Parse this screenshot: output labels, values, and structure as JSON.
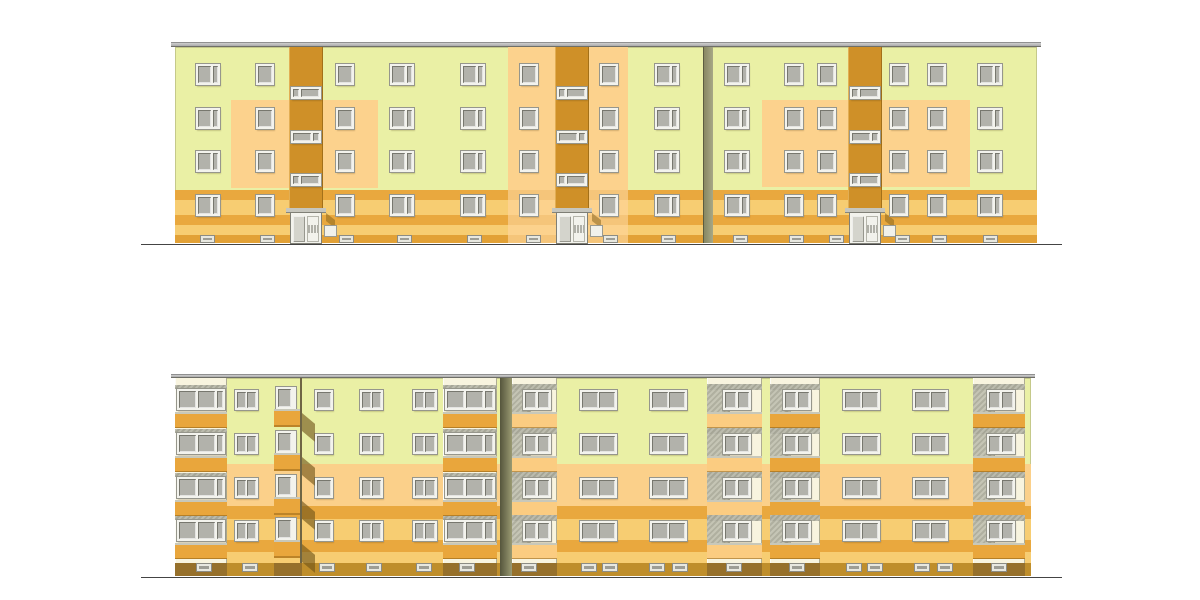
{
  "scene": {
    "width": 1200,
    "height": 600,
    "background": "#ffffff"
  },
  "colors": {
    "green": "#eaf0a5",
    "peach": "#fcd28d",
    "peachBand": "#fbd08a",
    "midStripe": "#f3c276",
    "stairwell": "#cf9028",
    "stripeDark": "#e9a83e",
    "stripeLight": "#f7cd72",
    "plinthTop": "#e2a136",
    "plinthBottom": "#bf8e2b",
    "plinthUnderStack": "#96702b",
    "parapetOrange": "#e9a63c",
    "parapetPeach": "#fbcc81",
    "cream": "#f8f4df",
    "slabGray": "#b4b4a5",
    "frame": "#f3f3ed",
    "glass": "#b2b2ab",
    "roof": "#bdbdbd",
    "ground": "#444444",
    "jointOliveLight": "#a8a886",
    "jointOliveDark": "#84845f",
    "jointShadowDark": "#55553c",
    "jointShadowLight": "#9a9a72",
    "edgeLine": "#6f6544",
    "canopy": "#c6c6be",
    "doorLeaf": "#d4d4cc",
    "shadow": "rgba(112,84,24,0.62)"
  },
  "ground_lines": [
    {
      "x": 141,
      "y": 244,
      "w": 921,
      "h": 1
    },
    {
      "x": 141,
      "y": 577,
      "w": 921,
      "h": 1
    }
  ],
  "top_building": {
    "wall": {
      "x": 175,
      "y": 47,
      "w": 862,
      "h": 196
    },
    "roof": {
      "x": 171,
      "y": 42,
      "w": 870,
      "h": 5
    },
    "stripes": [
      {
        "y": 190,
        "h": 10,
        "color": "stripeDark"
      },
      {
        "y": 200,
        "h": 15,
        "color": "stripeLight"
      },
      {
        "y": 215,
        "h": 10,
        "color": "stripeDark"
      },
      {
        "y": 225,
        "h": 10,
        "color": "stripeLight"
      },
      {
        "y": 235,
        "h": 8,
        "color": "plinthTop"
      }
    ],
    "patches": [
      {
        "x": 231,
        "y": 100,
        "w": 147,
        "h": 88
      },
      {
        "x": 762,
        "y": 100,
        "w": 208,
        "h": 87
      }
    ],
    "mid_column": {
      "x": 508,
      "w": 120,
      "stripes": [
        {
          "y": 190,
          "h": 10
        },
        {
          "y": 215,
          "h": 10
        },
        {
          "y": 235,
          "h": 8
        }
      ]
    },
    "joint": {
      "x": 703,
      "w": 10
    },
    "window_rows": [
      64,
      108,
      151,
      195
    ],
    "window_h": 21,
    "window_cols": [
      {
        "x": 196,
        "t": "d"
      },
      {
        "x": 256,
        "t": "s"
      },
      {
        "x": 336,
        "t": "s"
      },
      {
        "x": 390,
        "t": "d"
      },
      {
        "x": 461,
        "t": "d"
      },
      {
        "x": 520,
        "t": "s"
      },
      {
        "x": 600,
        "t": "s"
      },
      {
        "x": 655,
        "t": "d"
      },
      {
        "x": 725,
        "t": "d"
      },
      {
        "x": 785,
        "t": "s"
      },
      {
        "x": 818,
        "t": "s"
      },
      {
        "x": 890,
        "t": "s"
      },
      {
        "x": 928,
        "t": "s"
      },
      {
        "x": 978,
        "t": "d"
      }
    ],
    "stairwells": [
      {
        "x": 289
      },
      {
        "x": 555
      },
      {
        "x": 848
      }
    ],
    "stairwell_w": 34,
    "landing_ys": [
      87,
      131,
      174
    ],
    "canopy_y": 208,
    "door": {
      "y": 213,
      "h": 30
    },
    "vents": {
      "y": 236,
      "h": 6,
      "w": 13,
      "xs": [
        201,
        261,
        340,
        398,
        468,
        527,
        604,
        662,
        734,
        790,
        830,
        896,
        933,
        984
      ]
    }
  },
  "bottom_building": {
    "wall": {
      "x": 175,
      "y": 378,
      "w": 856,
      "h": 198
    },
    "roof": {
      "x": 171,
      "y": 374,
      "w": 864,
      "h": 4
    },
    "bands": [
      {
        "y": 464,
        "h": 42,
        "color": "peachBand"
      },
      {
        "y": 506,
        "h": 13,
        "color": "stripeDark"
      },
      {
        "y": 519,
        "h": 21,
        "color": "stripeLight"
      },
      {
        "y": 540,
        "h": 12,
        "color": "stripeDark"
      },
      {
        "y": 552,
        "h": 11,
        "color": "stripeLight"
      },
      {
        "y": 563,
        "h": 13,
        "color": "plinthBottom"
      }
    ],
    "joint": {
      "x": 500,
      "w": 12
    },
    "window_rows": [
      390,
      434,
      478,
      521
    ],
    "window_h": 20,
    "window_cols": [
      {
        "x": 235,
        "w": 23,
        "panes": 2
      },
      {
        "x": 315,
        "w": 18,
        "panes": 1
      },
      {
        "x": 360,
        "w": 23,
        "panes": 2
      },
      {
        "x": 413,
        "w": 24,
        "panes": 2
      },
      {
        "x": 580,
        "w": 37,
        "panes": 2
      },
      {
        "x": 650,
        "w": 37,
        "panes": 2
      },
      {
        "x": 843,
        "w": 37,
        "panes": 2
      },
      {
        "x": 913,
        "w": 35,
        "panes": 2
      }
    ],
    "stacks": [
      {
        "x": 175,
        "w": 52,
        "kind": "glazed",
        "parapet": "parapetOrange"
      },
      {
        "x": 274,
        "w": 28,
        "kind": "profile",
        "parapet": "parapetOrange"
      },
      {
        "x": 443,
        "w": 54,
        "kind": "glazed",
        "parapet": "parapetOrange"
      },
      {
        "x": 512,
        "w": 45,
        "kind": "window",
        "parapet": "parapetPeach"
      },
      {
        "x": 707,
        "w": 55,
        "kind": "window",
        "parapet": "parapetPeach"
      },
      {
        "x": 770,
        "w": 50,
        "kind": "window",
        "parapet": "parapetOrange"
      },
      {
        "x": 973,
        "w": 52,
        "kind": "window",
        "parapet": "parapetOrange"
      }
    ],
    "stack_top": 378,
    "stack_bottom": 563,
    "vents": {
      "y": 564,
      "h": 7,
      "w": 14,
      "xs": [
        197,
        243,
        320,
        367,
        417,
        460,
        522,
        582,
        603,
        650,
        673,
        727,
        790,
        847,
        868,
        915,
        938,
        992
      ]
    }
  }
}
